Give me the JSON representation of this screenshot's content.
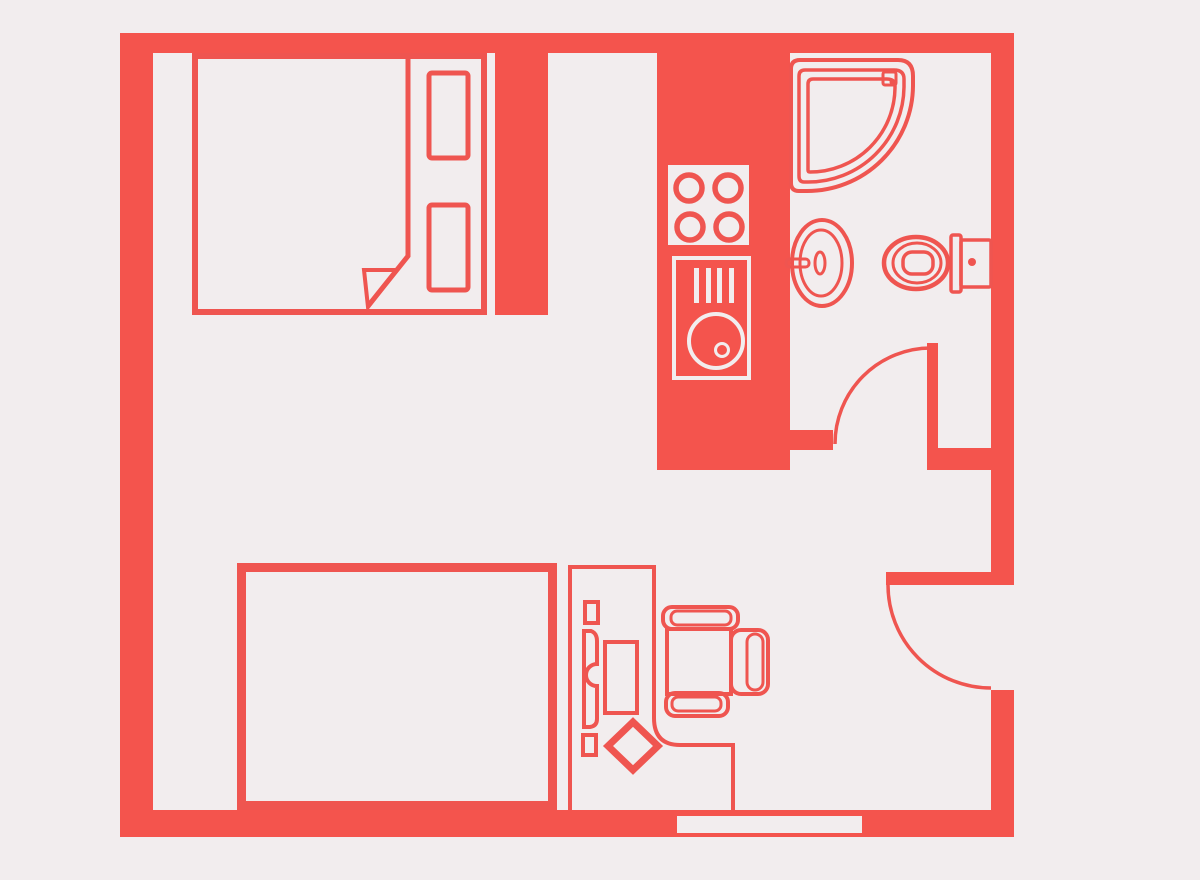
{
  "title": "studio-apartment-floor-plan",
  "canvas": {
    "width": 1200,
    "height": 880
  },
  "palette": {
    "background": "#f2edee",
    "floor": "#f2edee",
    "wall_red": "#f4544d",
    "furniture_red": "#ef5550",
    "appliance_stroke_white": "#f2edee"
  },
  "rooms": [
    {
      "id": "sleeping-nook",
      "label": "sleeping nook with double bed"
    },
    {
      "id": "kitchen-strip",
      "label": "kitchen strip with stove and washer"
    },
    {
      "id": "bathroom",
      "label": "bathroom with shower, sink and toilet"
    },
    {
      "id": "living-area",
      "label": "open living area"
    },
    {
      "id": "bedroom",
      "label": "bedroom with bed and desk"
    }
  ],
  "furniture": {
    "bed_top": {
      "label": "double bed with folded blanket",
      "pillows": 2
    },
    "stove": {
      "label": "cooktop",
      "burners": 4
    },
    "washer": {
      "label": "washing machine",
      "control_bars": 4
    },
    "shower": {
      "label": "corner shower",
      "contours": 3
    },
    "sink": {
      "label": "oval basin with faucet"
    },
    "toilet": {
      "label": "toilet with wall tank"
    },
    "bed_bottom": {
      "label": "single bed"
    },
    "desk": {
      "label": "desk zone with accessories",
      "items": 5
    },
    "chair": {
      "label": "office chair with armrests"
    }
  },
  "doors": [
    {
      "id": "bathroom-door",
      "label": "bathroom swing door",
      "state": "open"
    },
    {
      "id": "entry-door",
      "label": "entry swing door",
      "state": "open"
    }
  ],
  "window": {
    "id": "bottom-window",
    "label": "window in bottom wall"
  }
}
